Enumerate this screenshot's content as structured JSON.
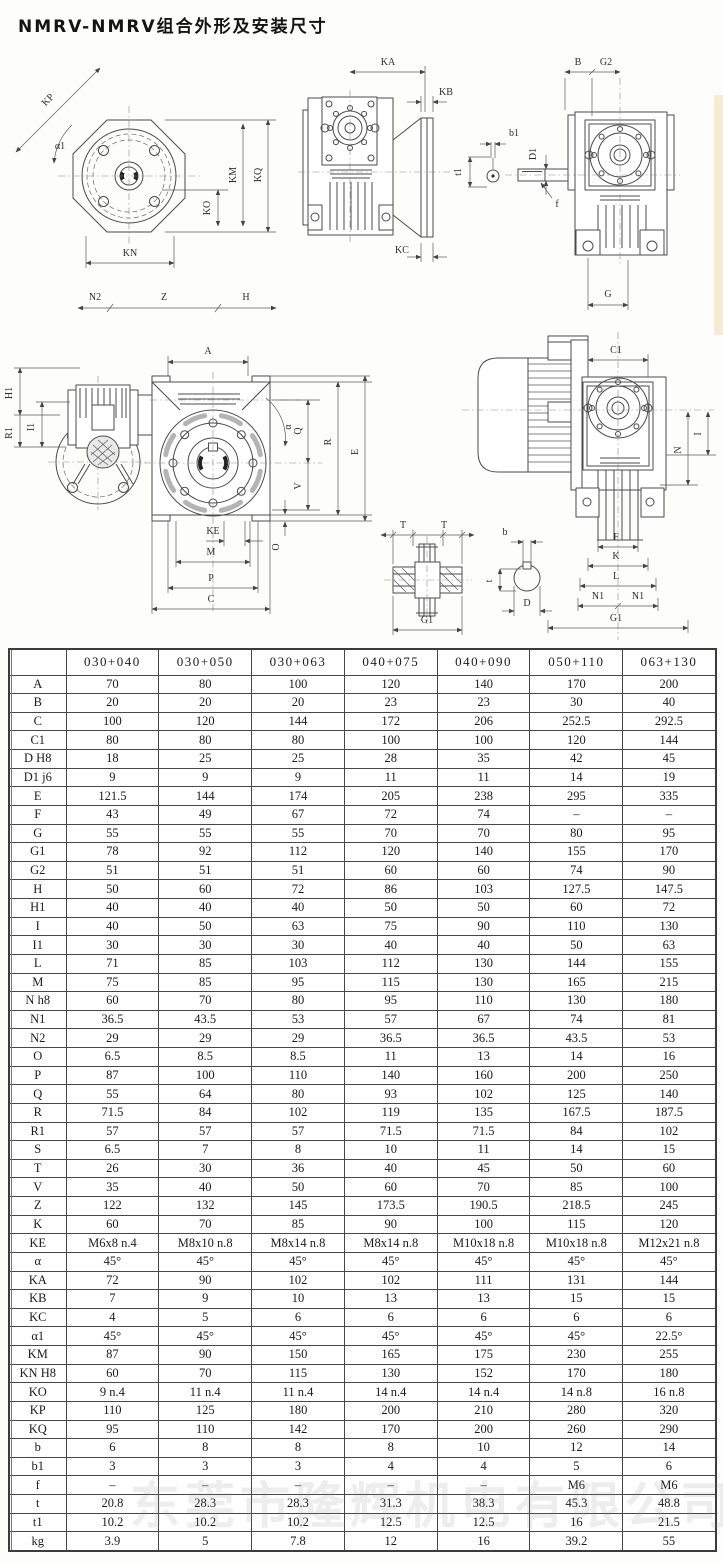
{
  "page": {
    "title": "NMRV-NMRV组合外形及安装尺寸",
    "watermark": "东莞市隆辉机电有限公司"
  },
  "drawings": {
    "flange_view": {
      "kp": "KP",
      "a1": "α1",
      "ko": "KO",
      "km": "KM",
      "kq": "KQ",
      "kn": "KN",
      "n2": "N2",
      "z": "Z",
      "h": "H"
    },
    "side_view": {
      "ka": "KA",
      "kb": "KB",
      "kc": "KC",
      "b1": "b1",
      "t1": "t1"
    },
    "front_view": {
      "b": "B",
      "g2": "G2",
      "d1": "D1",
      "f": "f",
      "g": "G"
    },
    "combo_view": {
      "h1": "H1",
      "r1": "R1",
      "i1": "I1"
    },
    "face_view": {
      "a": "A",
      "alpha": "α",
      "q": "Q",
      "v": "V",
      "o": "O",
      "r": "R",
      "e": "E",
      "ke": "KE",
      "m": "M",
      "p": "P",
      "c": "C"
    },
    "coupling_view": {
      "t_left": "T",
      "t_right": "T",
      "g1": "G1"
    },
    "shaft_view": {
      "b": "b",
      "t": "t",
      "d": "D"
    },
    "motor_view": {
      "c1": "C1",
      "i": "I",
      "n": "N",
      "f": "F",
      "k": "K",
      "l": "L",
      "n1a": "N1",
      "n1b": "N1",
      "g1": "G1"
    }
  },
  "table": {
    "header": [
      "",
      "030+040",
      "030+050",
      "030+063",
      "040+075",
      "040+090",
      "050+110",
      "063+130"
    ],
    "rows": [
      {
        "label": "A",
        "values": [
          "70",
          "80",
          "100",
          "120",
          "140",
          "170",
          "200"
        ]
      },
      {
        "label": "B",
        "values": [
          "20",
          "20",
          "20",
          "23",
          "23",
          "30",
          "40"
        ]
      },
      {
        "label": "C",
        "values": [
          "100",
          "120",
          "144",
          "172",
          "206",
          "252.5",
          "292.5"
        ]
      },
      {
        "label": "C1",
        "values": [
          "80",
          "80",
          "80",
          "100",
          "100",
          "120",
          "144"
        ]
      },
      {
        "label": "D H8",
        "values": [
          "18",
          "25",
          "25",
          "28",
          "35",
          "42",
          "45"
        ]
      },
      {
        "label": "D1 j6",
        "values": [
          "9",
          "9",
          "9",
          "11",
          "11",
          "14",
          "19"
        ]
      },
      {
        "label": "E",
        "values": [
          "121.5",
          "144",
          "174",
          "205",
          "238",
          "295",
          "335"
        ]
      },
      {
        "label": "F",
        "values": [
          "43",
          "49",
          "67",
          "72",
          "74",
          "–",
          "–"
        ]
      },
      {
        "label": "G",
        "values": [
          "55",
          "55",
          "55",
          "70",
          "70",
          "80",
          "95"
        ]
      },
      {
        "label": "G1",
        "values": [
          "78",
          "92",
          "112",
          "120",
          "140",
          "155",
          "170"
        ]
      },
      {
        "label": "G2",
        "values": [
          "51",
          "51",
          "51",
          "60",
          "60",
          "74",
          "90"
        ]
      },
      {
        "label": "H",
        "values": [
          "50",
          "60",
          "72",
          "86",
          "103",
          "127.5",
          "147.5"
        ]
      },
      {
        "label": "H1",
        "values": [
          "40",
          "40",
          "40",
          "50",
          "50",
          "60",
          "72"
        ]
      },
      {
        "label": "I",
        "values": [
          "40",
          "50",
          "63",
          "75",
          "90",
          "110",
          "130"
        ]
      },
      {
        "label": "I1",
        "values": [
          "30",
          "30",
          "30",
          "40",
          "40",
          "50",
          "63"
        ]
      },
      {
        "label": "L",
        "values": [
          "71",
          "85",
          "103",
          "112",
          "130",
          "144",
          "155"
        ]
      },
      {
        "label": "M",
        "values": [
          "75",
          "85",
          "95",
          "115",
          "130",
          "165",
          "215"
        ]
      },
      {
        "label": "N h8",
        "values": [
          "60",
          "70",
          "80",
          "95",
          "110",
          "130",
          "180"
        ]
      },
      {
        "label": "N1",
        "values": [
          "36.5",
          "43.5",
          "53",
          "57",
          "67",
          "74",
          "81"
        ]
      },
      {
        "label": "N2",
        "values": [
          "29",
          "29",
          "29",
          "36.5",
          "36.5",
          "43.5",
          "53"
        ]
      },
      {
        "label": "O",
        "values": [
          "6.5",
          "8.5",
          "8.5",
          "11",
          "13",
          "14",
          "16"
        ]
      },
      {
        "label": "P",
        "values": [
          "87",
          "100",
          "110",
          "140",
          "160",
          "200",
          "250"
        ]
      },
      {
        "label": "Q",
        "values": [
          "55",
          "64",
          "80",
          "93",
          "102",
          "125",
          "140"
        ]
      },
      {
        "label": "R",
        "values": [
          "71.5",
          "84",
          "102",
          "119",
          "135",
          "167.5",
          "187.5"
        ]
      },
      {
        "label": "R1",
        "values": [
          "57",
          "57",
          "57",
          "71.5",
          "71.5",
          "84",
          "102"
        ]
      },
      {
        "label": "S",
        "values": [
          "6.5",
          "7",
          "8",
          "10",
          "11",
          "14",
          "15"
        ]
      },
      {
        "label": "T",
        "values": [
          "26",
          "30",
          "36",
          "40",
          "45",
          "50",
          "60"
        ]
      },
      {
        "label": "V",
        "values": [
          "35",
          "40",
          "50",
          "60",
          "70",
          "85",
          "100"
        ]
      },
      {
        "label": "Z",
        "values": [
          "122",
          "132",
          "145",
          "173.5",
          "190.5",
          "218.5",
          "245"
        ]
      },
      {
        "label": "K",
        "values": [
          "60",
          "70",
          "85",
          "90",
          "100",
          "115",
          "120"
        ]
      },
      {
        "label": "KE",
        "values": [
          "M6x8 n.4",
          "M8x10 n.8",
          "M8x14 n.8",
          "M8x14 n.8",
          "M10x18 n.8",
          "M10x18 n.8",
          "M12x21 n.8"
        ]
      },
      {
        "label": "α",
        "values": [
          "45°",
          "45°",
          "45°",
          "45°",
          "45°",
          "45°",
          "45°"
        ]
      },
      {
        "label": "KA",
        "values": [
          "72",
          "90",
          "102",
          "102",
          "111",
          "131",
          "144"
        ]
      },
      {
        "label": "KB",
        "values": [
          "7",
          "9",
          "10",
          "13",
          "13",
          "15",
          "15"
        ]
      },
      {
        "label": "KC",
        "values": [
          "4",
          "5",
          "6",
          "6",
          "6",
          "6",
          "6"
        ]
      },
      {
        "label": "α1",
        "values": [
          "45°",
          "45°",
          "45°",
          "45°",
          "45°",
          "45°",
          "22.5°"
        ]
      },
      {
        "label": "KM",
        "values": [
          "87",
          "90",
          "150",
          "165",
          "175",
          "230",
          "255"
        ]
      },
      {
        "label": "KN H8",
        "values": [
          "60",
          "70",
          "115",
          "130",
          "152",
          "170",
          "180"
        ]
      },
      {
        "label": "KO",
        "values": [
          "9 n.4",
          "11 n.4",
          "11 n.4",
          "14 n.4",
          "14 n.4",
          "14 n.8",
          "16 n.8"
        ]
      },
      {
        "label": "KP",
        "values": [
          "110",
          "125",
          "180",
          "200",
          "210",
          "280",
          "320"
        ]
      },
      {
        "label": "KQ",
        "values": [
          "95",
          "110",
          "142",
          "170",
          "200",
          "260",
          "290"
        ]
      },
      {
        "label": "b",
        "values": [
          "6",
          "8",
          "8",
          "8",
          "10",
          "12",
          "14"
        ]
      },
      {
        "label": "b1",
        "values": [
          "3",
          "3",
          "3",
          "4",
          "4",
          "5",
          "6"
        ]
      },
      {
        "label": "f",
        "values": [
          "–",
          "–",
          "–",
          "–",
          "–",
          "M6",
          "M6"
        ]
      },
      {
        "label": "t",
        "values": [
          "20.8",
          "28.3",
          "28.3",
          "31.3",
          "38.3",
          "45.3",
          "48.8"
        ]
      },
      {
        "label": "t1",
        "values": [
          "10.2",
          "10.2",
          "10.2",
          "12.5",
          "12.5",
          "16",
          "21.5"
        ]
      },
      {
        "label": "kg",
        "values": [
          "3.9",
          "5",
          "7.8",
          "12",
          "16",
          "39.2",
          "55"
        ]
      }
    ]
  }
}
